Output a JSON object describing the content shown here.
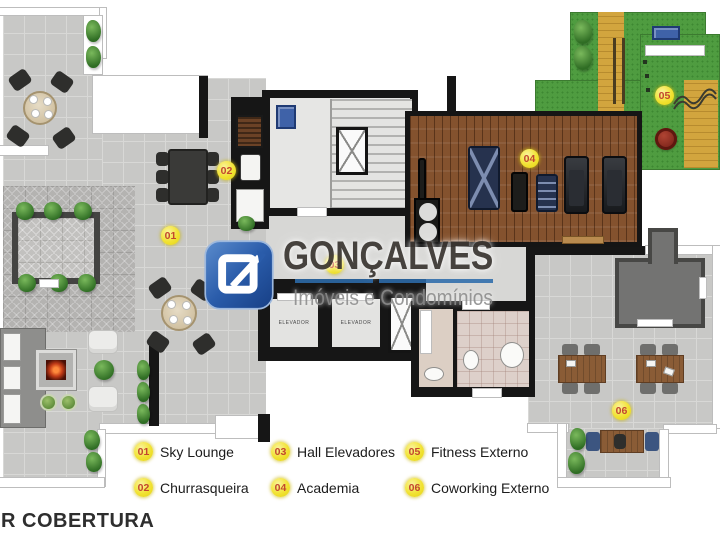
{
  "title": "R COBERTURA",
  "watermark": {
    "name": "GONÇALVES",
    "tagline": "Imóveis e Condomínios"
  },
  "plan": {
    "elevator_label": "ELEVADOR",
    "markers": [
      "01",
      "02",
      "03",
      "04",
      "05",
      "06"
    ]
  },
  "legend": {
    "items": [
      {
        "number": "01",
        "label": "Sky Lounge"
      },
      {
        "number": "02",
        "label": "Churrasqueira"
      },
      {
        "number": "03",
        "label": "Hall Elevadores"
      },
      {
        "number": "04",
        "label": "Academia"
      },
      {
        "number": "05",
        "label": "Fitness Externo"
      },
      {
        "number": "06",
        "label": "Coworking Externo"
      }
    ]
  },
  "colors": {
    "marker_yellow": "#f1e232",
    "marker_number": "#c2472e",
    "logo_blue": "#2a5caa",
    "underline_blue": "#2d6cab",
    "grass_green": "#4f9c40",
    "path_tan": "#d2a53e",
    "wood_brown": "#84522e"
  }
}
